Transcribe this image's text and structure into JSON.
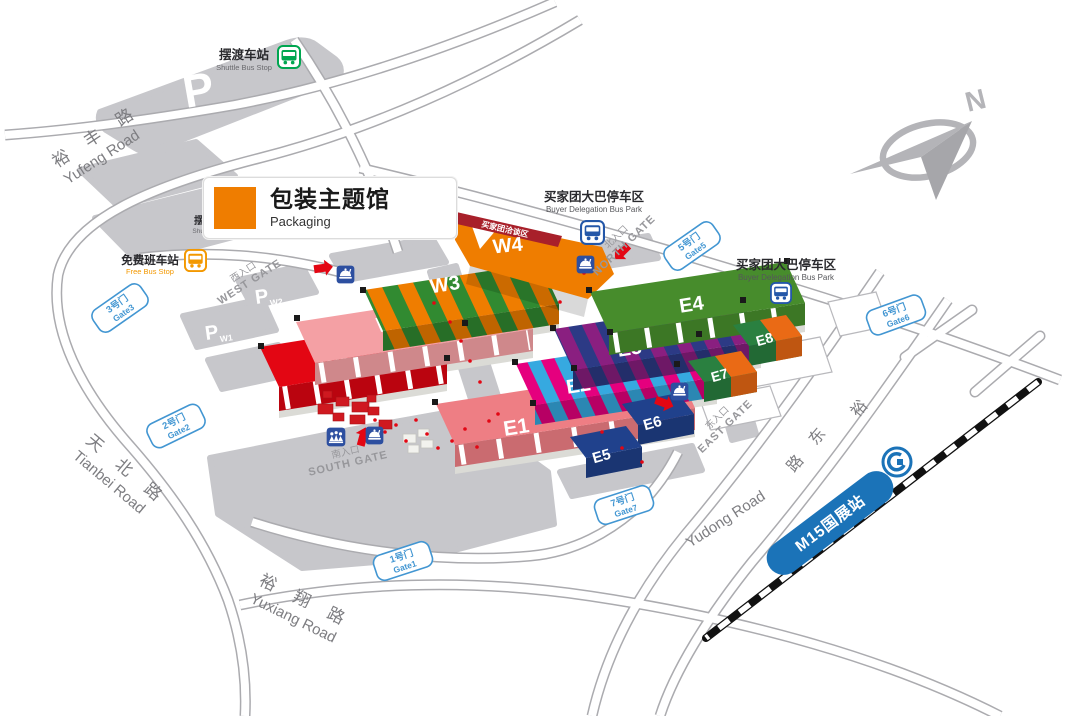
{
  "legend": {
    "title_zh": "包装主题馆",
    "title_en": "Packaging",
    "swatch_color": "#ef7d00"
  },
  "compass": {
    "north_label": "N"
  },
  "roads": {
    "yufeng_zh": "裕 丰 路",
    "yufeng_en": "Yufeng Road",
    "tianbei_zh": "天 北 路",
    "tianbei_en": "Tianbei Road",
    "yuxiang_zh": "裕 翔 路",
    "yuxiang_en": "Yuxiang Road",
    "yudong_en": "Yudong Road",
    "yudong_zh_1": "裕",
    "yudong_zh_2": "东",
    "yudong_zh_3": "路"
  },
  "transit": {
    "shuttle_zh": "摆渡车站",
    "shuttle_en": "Shuttle Bus Stop",
    "shuttle_partial_zh": "摆",
    "shuttle_partial_en": "Shu",
    "free_zh": "免费班车站",
    "free_en": "Free Bus Stop",
    "bus_park_north_zh": "买家团大巴停车区",
    "bus_park_north_en": "Buyer Delegation Bus Park",
    "bus_park_east_zh": "买家团大巴停车区",
    "bus_park_east_en": "Buyer Delegation Bus Park",
    "metro_label": "M15国展站"
  },
  "gates": {
    "gate1_zh": "1号门",
    "gate1_en": "Gate1",
    "gate2_zh": "2号门",
    "gate2_en": "Gate2",
    "gate3_zh": "3号门",
    "gate3_en": "Gate3",
    "gate5_zh": "5号门",
    "gate5_en": "Gate5",
    "gate6_zh": "6号门",
    "gate6_en": "Gate6",
    "gate7_zh": "7号门",
    "gate7_en": "Gate7"
  },
  "entrances": {
    "west_zh": "西入口",
    "west_en": "WEST GATE",
    "north_zh": "北入口",
    "north_en": "NORTH GATE",
    "east_zh": "东入口",
    "east_en": "EAST GATE",
    "south_zh": "南入口",
    "south_en": "SOUTH GATE"
  },
  "halls": {
    "W1": {
      "label": "W1",
      "color": "#e30613"
    },
    "W2": {
      "label": "W2",
      "color": "#f4a0a4"
    },
    "W3": {
      "label": "W3",
      "color_a": "#ef7d00",
      "color_b": "#318a31"
    },
    "W4": {
      "label": "W4",
      "color": "#ef7d00",
      "banner": "买家团洽谈区",
      "banner_color": "#a8202a"
    },
    "E1": {
      "label": "E1",
      "color": "#ee7e84"
    },
    "E2": {
      "label": "E2",
      "color_a": "#e5007e",
      "color_b": "#36a9e0"
    },
    "E3": {
      "label": "E3",
      "color_a": "#8a1f80",
      "color_b": "#2c3a85"
    },
    "E4": {
      "label": "E4",
      "color": "#478c2c"
    },
    "E5": {
      "label": "E5",
      "color": "#20418c"
    },
    "E6": {
      "label": "E6",
      "color": "#20418c"
    },
    "E7": {
      "label": "E7",
      "color_a": "#2a8040",
      "color_b": "#ea6a15"
    },
    "E8": {
      "label": "E8",
      "color_a": "#2a8040",
      "color_b": "#ea6a15"
    }
  },
  "parking": {
    "main_label": "P",
    "w1_p": "P",
    "w1_sub": "W1",
    "w2_p": "P",
    "w2_sub": "W2"
  },
  "colors": {
    "gate_blue": "#4296d2",
    "road_gray": "#ababaf",
    "block_gray": "#c7c7cb",
    "metro_blue": "#1b73b8",
    "shuttle_green": "#00a650",
    "free_bus_orange": "#f39800",
    "delegation_bus_blue": "#2457a8",
    "facility_blue": "#2d4fa0",
    "arrow_red": "#e30613"
  }
}
